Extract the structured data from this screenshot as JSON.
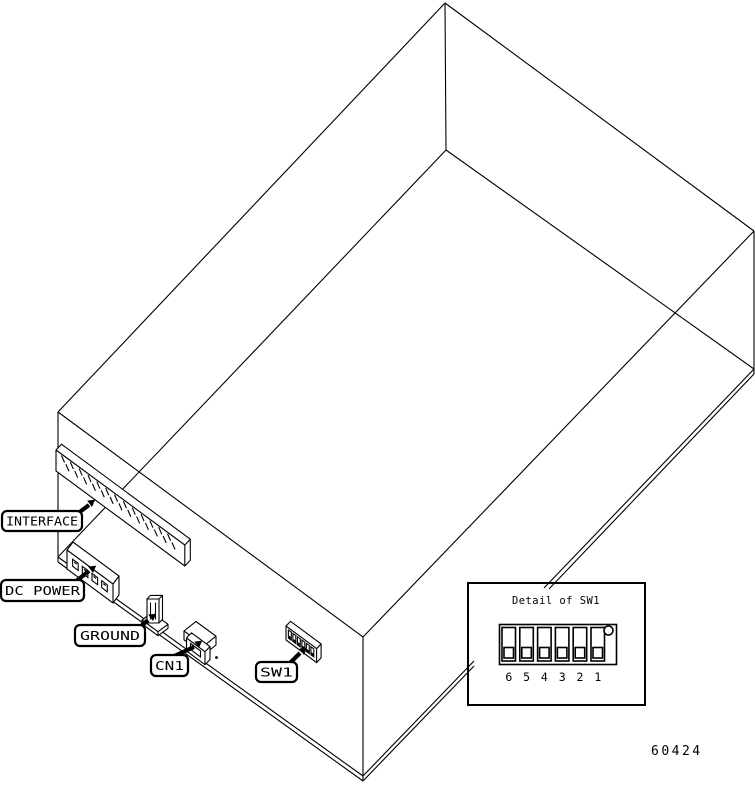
{
  "figure": {
    "number": "60424",
    "background_color": "#ffffff",
    "line_color": "#000000",
    "description": "Isometric wireframe drawing of device chassis rear panel with connector callouts"
  },
  "callouts": {
    "interface": "INTERFACE",
    "dc_power": "DC POWER",
    "ground": "GROUND",
    "cn1": "CN1",
    "sw1": "SW1"
  },
  "detail": {
    "title": "Detail of SW1",
    "positions": [
      "6",
      "5",
      "4",
      "3",
      "2",
      "1"
    ],
    "switch_state": "all sliders down"
  },
  "connectors": {
    "interface_pin_marks": 26,
    "dc_power_pin_holes": 4,
    "sw1_switch_count": 6
  }
}
